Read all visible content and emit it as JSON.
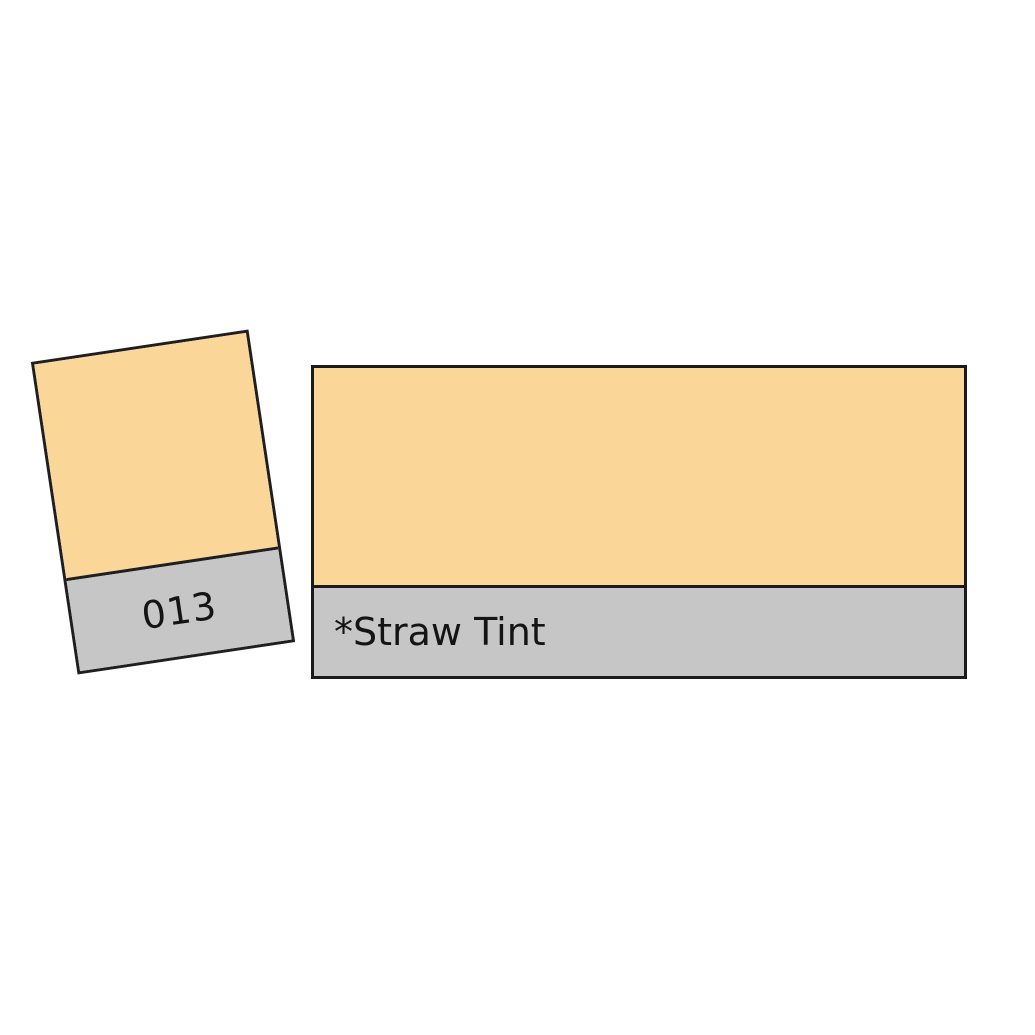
{
  "product": {
    "code": "013",
    "name": "*Straw Tint"
  },
  "colors": {
    "swatch_fill": "#FBD699",
    "label_band_bg": "#C6C6C6",
    "border": "#1F1F1F",
    "text": "#141414",
    "background": "#FFFFFF"
  }
}
